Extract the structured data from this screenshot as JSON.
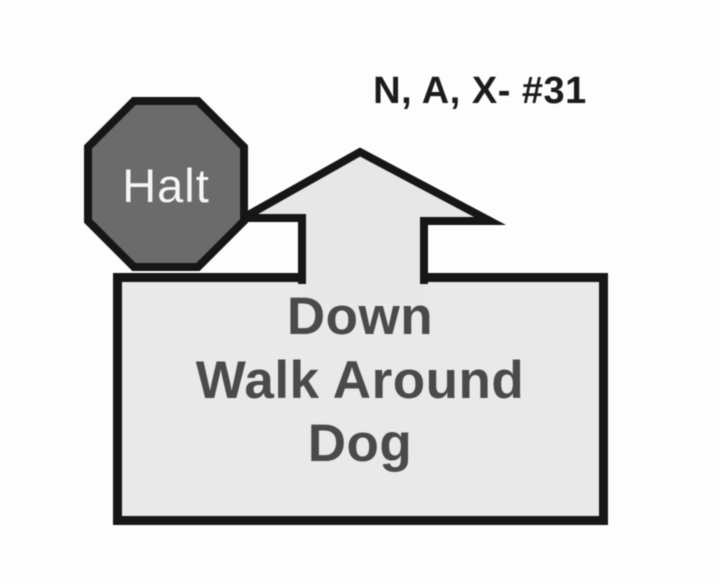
{
  "page": {
    "background": "#fdfdfd"
  },
  "header": {
    "class_label": "N, A, X- #31",
    "text_color": "#1b1b1b"
  },
  "halt_sign": {
    "label": "Halt",
    "shape": "octagon",
    "fill": "#6b6b6b",
    "border_color": "#161616",
    "text_color": "#f6f6f6"
  },
  "arrow": {
    "icon": "up-arrow",
    "fill": "#e7e7e7",
    "border_color": "#161616"
  },
  "sign_box": {
    "lines": [
      "Down",
      "Walk Around",
      "Dog"
    ],
    "fill": "#e9e9e9",
    "border_color": "#161616",
    "text_color": "#4a4a4a"
  }
}
